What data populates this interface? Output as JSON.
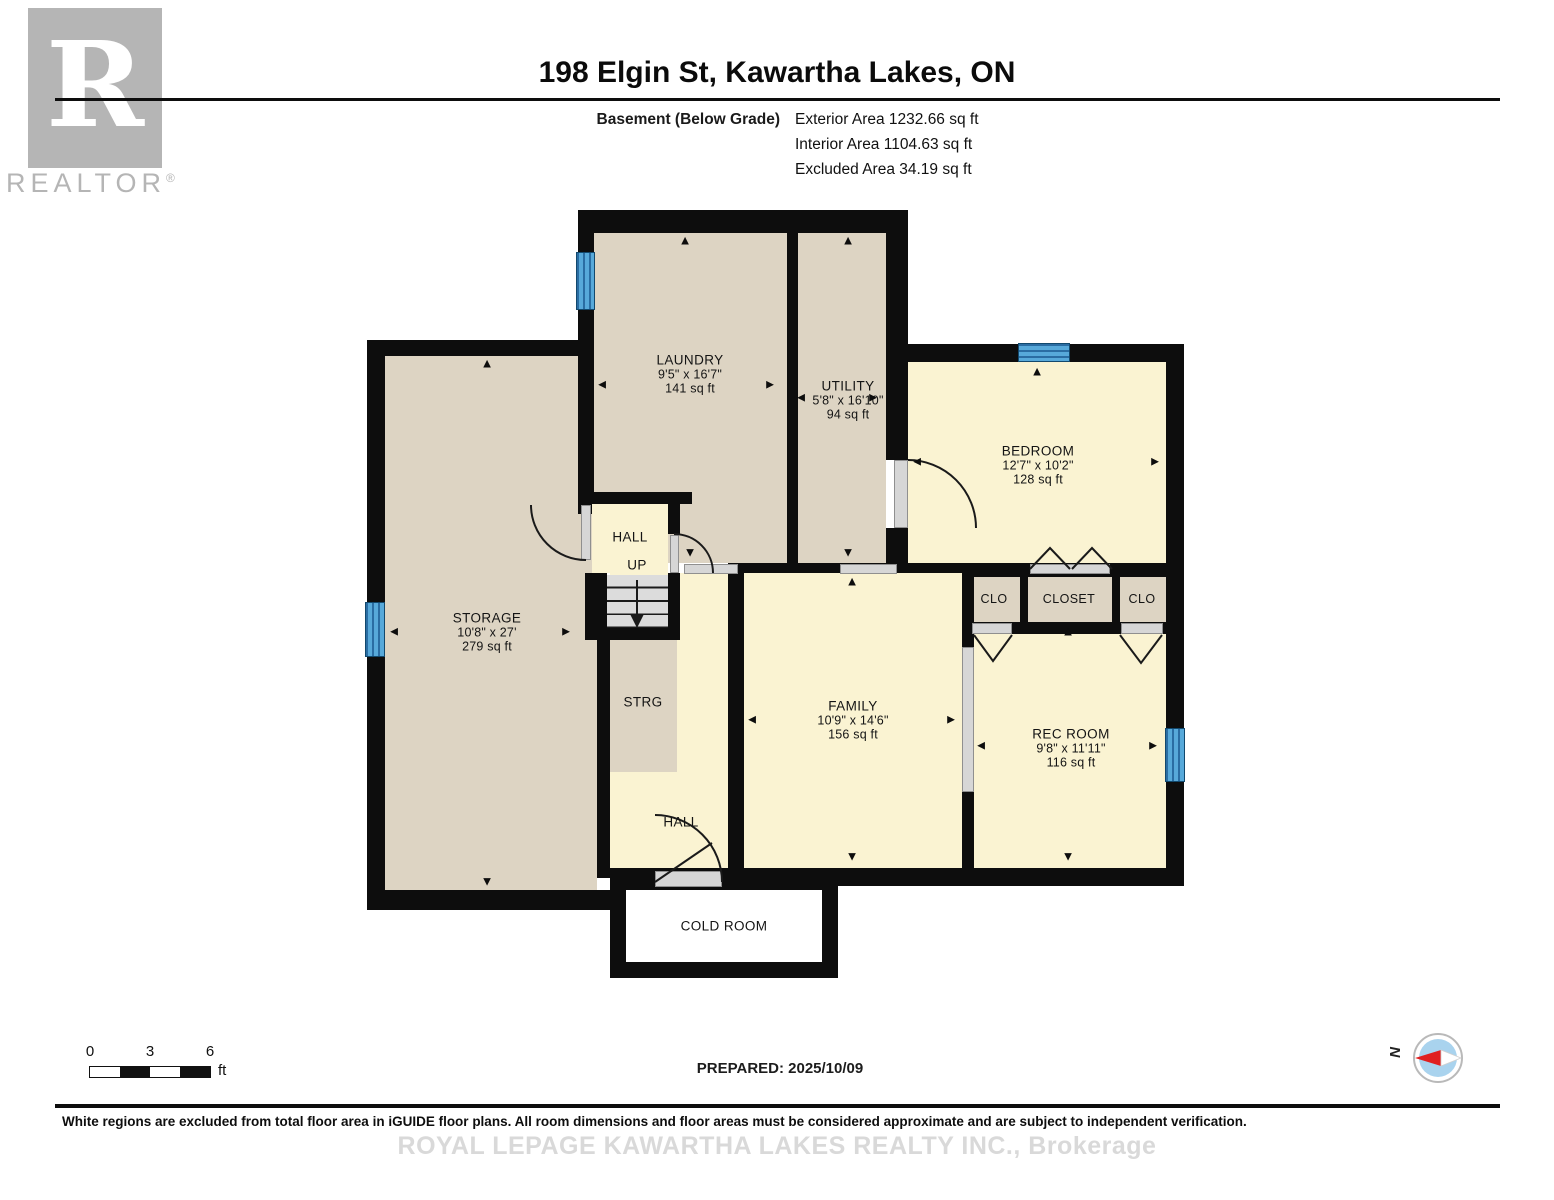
{
  "header": {
    "title": "198 Elgin St, Kawartha Lakes, ON",
    "floor_label": "Basement (Below Grade)",
    "areas": {
      "exterior": "Exterior Area 1232.66 sq ft",
      "interior": "Interior Area 1104.63 sq ft",
      "excluded": "Excluded Area 34.19 sq ft"
    },
    "logo": {
      "letter": "R",
      "word": "REALTOR",
      "registered": "®"
    }
  },
  "rooms": {
    "laundry": {
      "name": "LAUNDRY",
      "dims": "9'5\" x 16'7\"",
      "area": "141 sq ft"
    },
    "utility": {
      "name": "UTILITY",
      "dims": "5'8\" x 16'10\"",
      "area": "94 sq ft"
    },
    "bedroom": {
      "name": "BEDROOM",
      "dims": "12'7\" x 10'2\"",
      "area": "128 sq ft"
    },
    "storage": {
      "name": "STORAGE",
      "dims": "10'8\" x 27'",
      "area": "279 sq ft"
    },
    "hall_upper": {
      "name": "HALL",
      "up": "UP"
    },
    "strg": {
      "name": "STRG"
    },
    "hall_lower": {
      "name": "HALL"
    },
    "family": {
      "name": "FAMILY",
      "dims": "10'9\" x 14'6\"",
      "area": "156 sq ft"
    },
    "clo_left": {
      "name": "CLO"
    },
    "closet": {
      "name": "CLOSET"
    },
    "clo_right": {
      "name": "CLO"
    },
    "rec_room": {
      "name": "REC ROOM",
      "dims": "9'8\" x 11'11\"",
      "area": "116 sq ft"
    },
    "cold_room": {
      "name": "COLD ROOM"
    }
  },
  "icons": {
    "up": "▲",
    "down": "▼",
    "left": "◄",
    "right": "►"
  },
  "footer": {
    "scale": {
      "tick0": "0",
      "tick3": "3",
      "tick6": "6",
      "unit": "ft"
    },
    "prepared": "PREPARED: 2025/10/09",
    "compass": "N",
    "disclaimer": "White regions are excluded from total floor area in iGUIDE floor plans. All room dimensions and floor areas must be considered approximate and are subject to independent verification.",
    "watermark": "ROYAL LEPAGE KAWARTHA LAKES REALTY INC., Brokerage"
  },
  "colors": {
    "wall": "#0d0d0d",
    "room_tan": "#ddd4c3",
    "room_cream": "#faf3d2",
    "excluded_white": "#ffffff",
    "window_blue": "#57a9da",
    "window_stripe": "#2a6da3",
    "door_gray": "#d6d6d6",
    "logo_gray": "#b5b5b5",
    "watermark_gray": "#d9d9d9"
  }
}
